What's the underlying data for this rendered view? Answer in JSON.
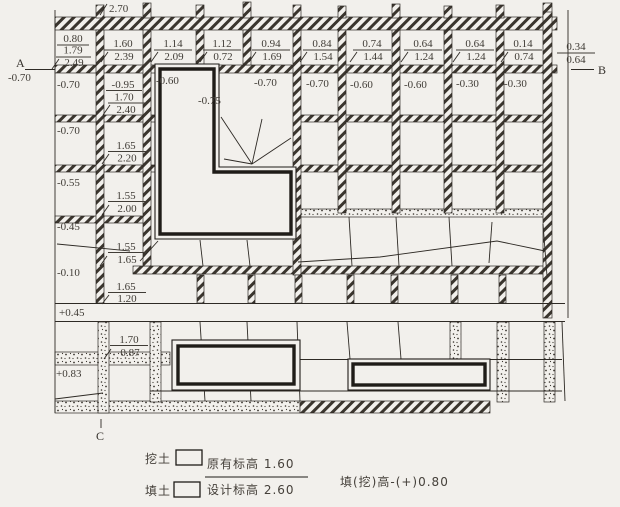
{
  "drawing": {
    "top_elevation": "2.70",
    "section_labels": {
      "a": "A",
      "a_value": "-0.70",
      "b": "B",
      "c": "C"
    },
    "node_fractions": [
      {
        "top": "0.80",
        "mid": "1.79",
        "bottom": "2.49"
      },
      {
        "top": "1.60",
        "bottom": "2.39"
      },
      {
        "top": "1.14",
        "bottom": "2.09"
      },
      {
        "top": "1.12",
        "bottom": "0.72"
      },
      {
        "top": "0.94",
        "bottom": "1.69"
      },
      {
        "top": "0.84",
        "bottom": "1.54"
      },
      {
        "top": "0.74",
        "bottom": "1.44"
      },
      {
        "top": "0.64",
        "bottom": "1.24"
      },
      {
        "top": "0.64",
        "bottom": "1.24"
      },
      {
        "top": "0.14",
        "bottom": "0.74"
      },
      {
        "top": "0.34",
        "bottom": "0.64"
      }
    ],
    "row2_values": [
      "-0.70",
      "-0.95",
      "-0.60",
      "-0.75",
      "-0.70",
      "-0.70",
      "-0.60",
      "-0.60",
      "-0.30",
      "-0.30"
    ],
    "row2_fraction": {
      "top": "1.70",
      "bottom": "2.40"
    },
    "left_values": [
      "-0.70",
      "-0.55",
      "-0.45",
      "-0.10",
      "+0.45",
      "+0.83"
    ],
    "col2_fractions": [
      {
        "top": "1.65",
        "bottom": "2.20"
      },
      {
        "top": "1.55",
        "bottom": "2.00"
      },
      {
        "top": "1.55",
        "bottom": "1.65"
      },
      {
        "top": "1.65",
        "bottom": "1.20"
      },
      {
        "top": "1.70",
        "bottom": "0.87"
      }
    ]
  },
  "legend": {
    "cut_label": "挖土",
    "fill_label": "填土",
    "original_elevation": "原有标高 1.60",
    "design_elevation": "设计标高 2.60",
    "formula": "填(挖)高-(+)0.80"
  }
}
